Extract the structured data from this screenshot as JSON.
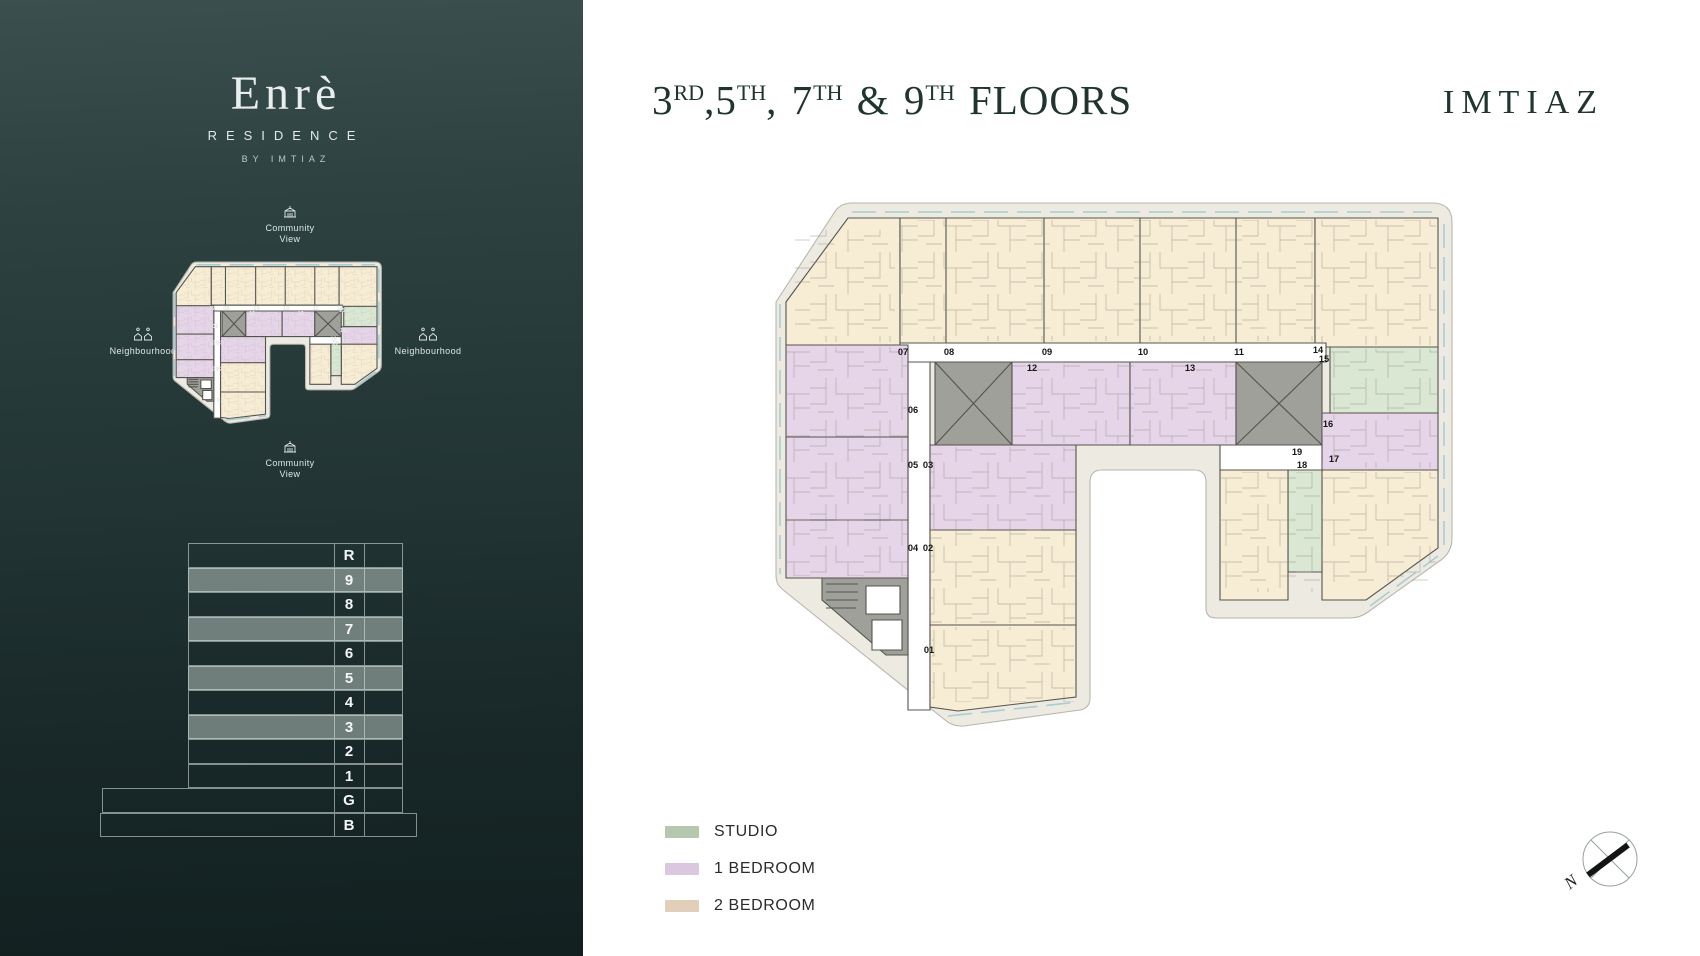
{
  "brand": {
    "logo_title": "Enrè",
    "logo_subtitle": "RESIDENCE",
    "logo_byline": "BY IMTIAZ",
    "wordmark": "IMTIAZ"
  },
  "header": {
    "title_parts": [
      {
        "base": "3",
        "sup": "RD"
      },
      {
        "base": ",5",
        "sup": "TH"
      },
      {
        "base": ", 7",
        "sup": "TH"
      },
      {
        "base": " & 9",
        "sup": "TH"
      },
      {
        "base": " FLOORS",
        "sup": ""
      }
    ]
  },
  "sidebar": {
    "site_map": {
      "labels": {
        "top": "Community View",
        "bottom": "Community View",
        "left": "Neighbourhood",
        "right": "Neighbourhood"
      }
    },
    "floor_table": {
      "rows": [
        {
          "label": "R",
          "highlight": false
        },
        {
          "label": "9",
          "highlight": true
        },
        {
          "label": "8",
          "highlight": false
        },
        {
          "label": "7",
          "highlight": true
        },
        {
          "label": "6",
          "highlight": false
        },
        {
          "label": "5",
          "highlight": true
        },
        {
          "label": "4",
          "highlight": false
        },
        {
          "label": "3",
          "highlight": true
        },
        {
          "label": "2",
          "highlight": false
        },
        {
          "label": "1",
          "highlight": false
        },
        {
          "label": "G",
          "highlight": false
        },
        {
          "label": "B",
          "highlight": false
        }
      ]
    }
  },
  "legend": {
    "items": [
      {
        "label": "STUDIO",
        "color": "#b7c6ae"
      },
      {
        "label": "1 BEDROOM",
        "color": "#dcc7e1"
      },
      {
        "label": "2 BEDROOM",
        "color": "#e1cfba"
      }
    ]
  },
  "floor_plan": {
    "units": [
      {
        "label": "01",
        "type": "2 BEDROOM",
        "x": 929,
        "y": 650
      },
      {
        "label": "02",
        "type": "2 BEDROOM",
        "x": 928,
        "y": 548
      },
      {
        "label": "03",
        "type": "1 BEDROOM",
        "x": 928,
        "y": 465
      },
      {
        "label": "04",
        "type": "1 BEDROOM",
        "x": 913,
        "y": 548
      },
      {
        "label": "05",
        "type": "1 BEDROOM",
        "x": 913,
        "y": 465
      },
      {
        "label": "06",
        "type": "1 BEDROOM",
        "x": 913,
        "y": 410
      },
      {
        "label": "07",
        "type": "2 BEDROOM",
        "x": 903,
        "y": 352
      },
      {
        "label": "08",
        "type": "2 BEDROOM",
        "x": 949,
        "y": 352
      },
      {
        "label": "09",
        "type": "2 BEDROOM",
        "x": 1047,
        "y": 352
      },
      {
        "label": "10",
        "type": "2 BEDROOM",
        "x": 1143,
        "y": 352
      },
      {
        "label": "11",
        "type": "2 BEDROOM",
        "x": 1239,
        "y": 352
      },
      {
        "label": "12",
        "type": "1 BEDROOM",
        "x": 1032,
        "y": 368
      },
      {
        "label": "13",
        "type": "1 BEDROOM",
        "x": 1190,
        "y": 368
      },
      {
        "label": "14",
        "type": "2 BEDROOM",
        "x": 1318,
        "y": 350
      },
      {
        "label": "15",
        "type": "STUDIO",
        "x": 1324,
        "y": 359
      },
      {
        "label": "16",
        "type": "1 BEDROOM",
        "x": 1328,
        "y": 424
      },
      {
        "label": "17",
        "type": "2 BEDROOM",
        "x": 1334,
        "y": 459
      },
      {
        "label": "18",
        "type": "STUDIO",
        "x": 1302,
        "y": 465
      },
      {
        "label": "19",
        "type": "2 BEDROOM",
        "x": 1297,
        "y": 452
      }
    ]
  },
  "compass": {
    "label": "N"
  }
}
